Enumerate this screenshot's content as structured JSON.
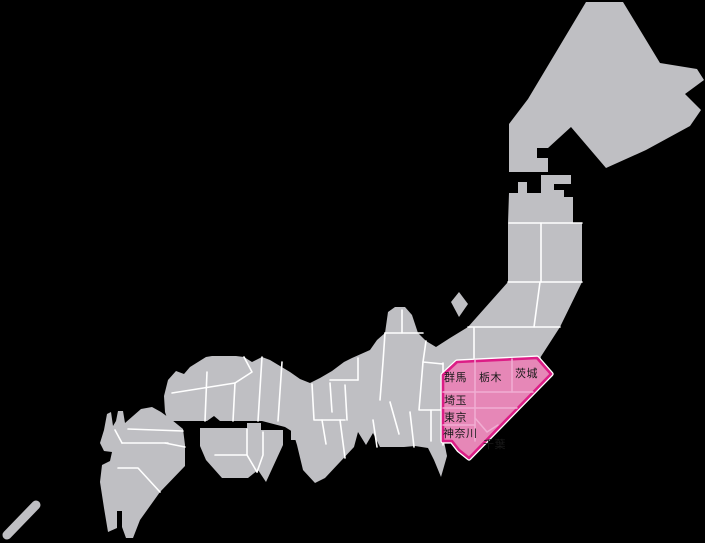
{
  "colors": {
    "background": "#000000",
    "land": "#bfbfc3",
    "prefecture_border": "#ffffff",
    "highlight_fill": "#e687b7",
    "highlight_border": "#dc1d86",
    "highlight_inner_border": "#f0aed3",
    "label_text": "#1a1a1a"
  },
  "kanto": {
    "labels": [
      {
        "text": "群馬"
      },
      {
        "text": "栃木"
      },
      {
        "text": "茨城"
      },
      {
        "text": "埼玉"
      },
      {
        "text": "東京"
      },
      {
        "text": "神奈川"
      },
      {
        "text": "千葉"
      }
    ]
  }
}
